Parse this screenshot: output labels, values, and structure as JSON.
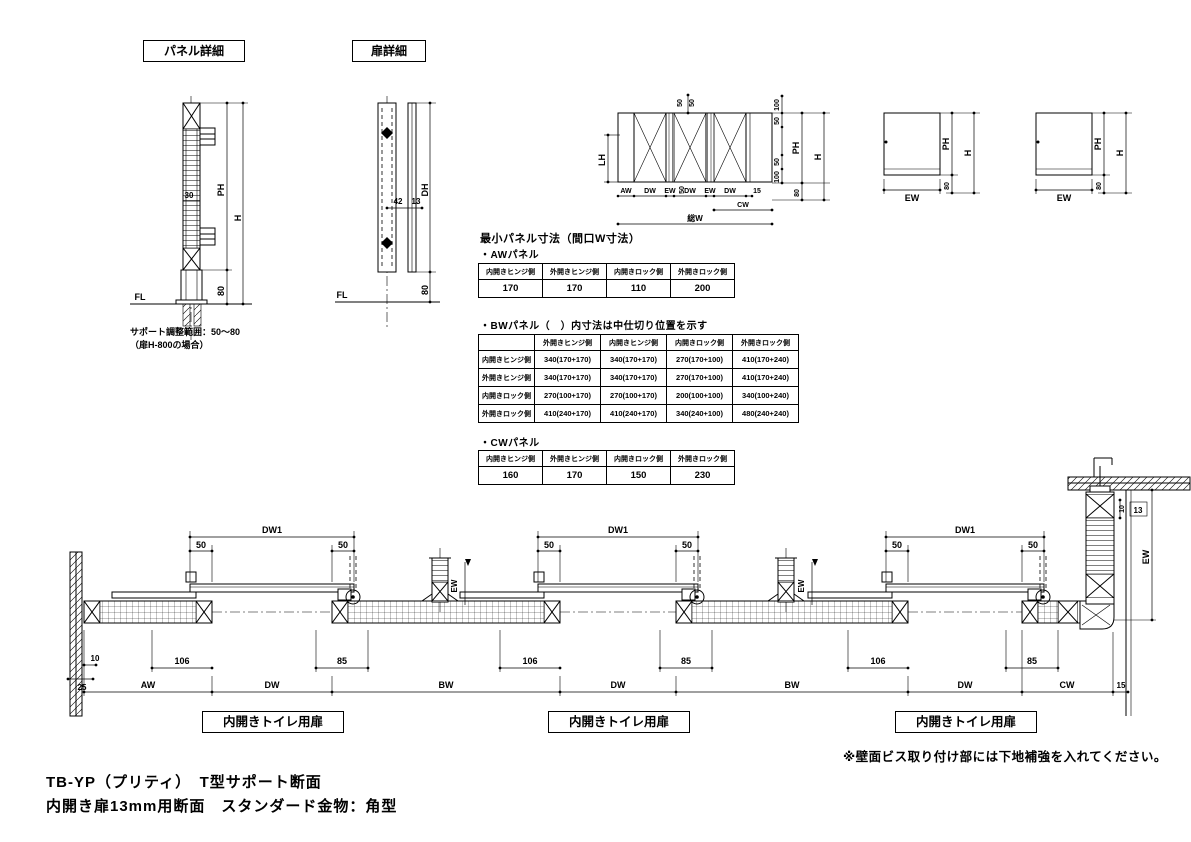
{
  "titles": {
    "panel_box": "パネル詳細",
    "door_box": "扉詳細"
  },
  "panel_detail": {
    "fl": "FL",
    "ph": "PH",
    "h": "H",
    "d80": "80",
    "d30": "30",
    "note1": "サポート調整範囲：50～80",
    "note2": "（扉H-800の場合）"
  },
  "door_detail": {
    "fl": "FL",
    "dh": "DH",
    "d80": "80",
    "d42": "42",
    "d13": "13"
  },
  "elevation": {
    "lh": "LH",
    "d50": "50",
    "aw": "AW",
    "dw": "DW",
    "ew": "EW",
    "d15": "15",
    "cw": "CW",
    "total": "総W",
    "d100": "100",
    "ph": "PH",
    "h": "H",
    "d80": "80"
  },
  "end_panel": {
    "ew": "EW",
    "ph": "PH",
    "h": "H",
    "d80": "80"
  },
  "tables": {
    "main_title": "最小パネル寸法（間口W寸法）",
    "aw": {
      "title": "・AWパネル",
      "headers": [
        "内開きヒンジ側",
        "外開きヒンジ側",
        "内開きロック側",
        "外開きロック側"
      ],
      "values": [
        "170",
        "170",
        "110",
        "200"
      ]
    },
    "bw": {
      "title": "・BWパネル（　）内寸法は中仕切り位置を示す",
      "col_headers": [
        "外開きヒンジ側",
        "内開きヒンジ側",
        "内開きロック側",
        "外開きロック側"
      ],
      "rows": [
        {
          "header": "内開きヒンジ側",
          "values": [
            "340(170+170)",
            "340(170+170)",
            "270(170+100)",
            "410(170+240)"
          ]
        },
        {
          "header": "外開きヒンジ側",
          "values": [
            "340(170+170)",
            "340(170+170)",
            "270(170+100)",
            "410(170+240)"
          ]
        },
        {
          "header": "内開きロック側",
          "values": [
            "270(100+170)",
            "270(100+170)",
            "200(100+100)",
            "340(100+240)"
          ]
        },
        {
          "header": "外開きロック側",
          "values": [
            "410(240+170)",
            "410(240+170)",
            "340(240+100)",
            "480(240+240)"
          ]
        }
      ]
    },
    "cw": {
      "title": "・CWパネル",
      "headers": [
        "内開きヒンジ側",
        "外開きヒンジ側",
        "内開きロック側",
        "外開きロック側"
      ],
      "values": [
        "160",
        "170",
        "150",
        "230"
      ]
    }
  },
  "section": {
    "dw1": "DW1",
    "d50": "50",
    "d106": "106",
    "d85": "85",
    "d10": "10",
    "d25": "25",
    "d13": "13",
    "d15": "15",
    "ew": "EW",
    "aw": "AW",
    "dw": "DW",
    "bw": "BW",
    "cw": "CW",
    "door_label": "内開きトイレ用扉",
    "note": "※壁面ビス取り付け部には下地補強を入れてください。"
  },
  "footer": {
    "line1": "TB-YP（プリティ）　T型サポート断面",
    "line2": "内開き扉13mm用断面　スタンダード金物：角型"
  }
}
